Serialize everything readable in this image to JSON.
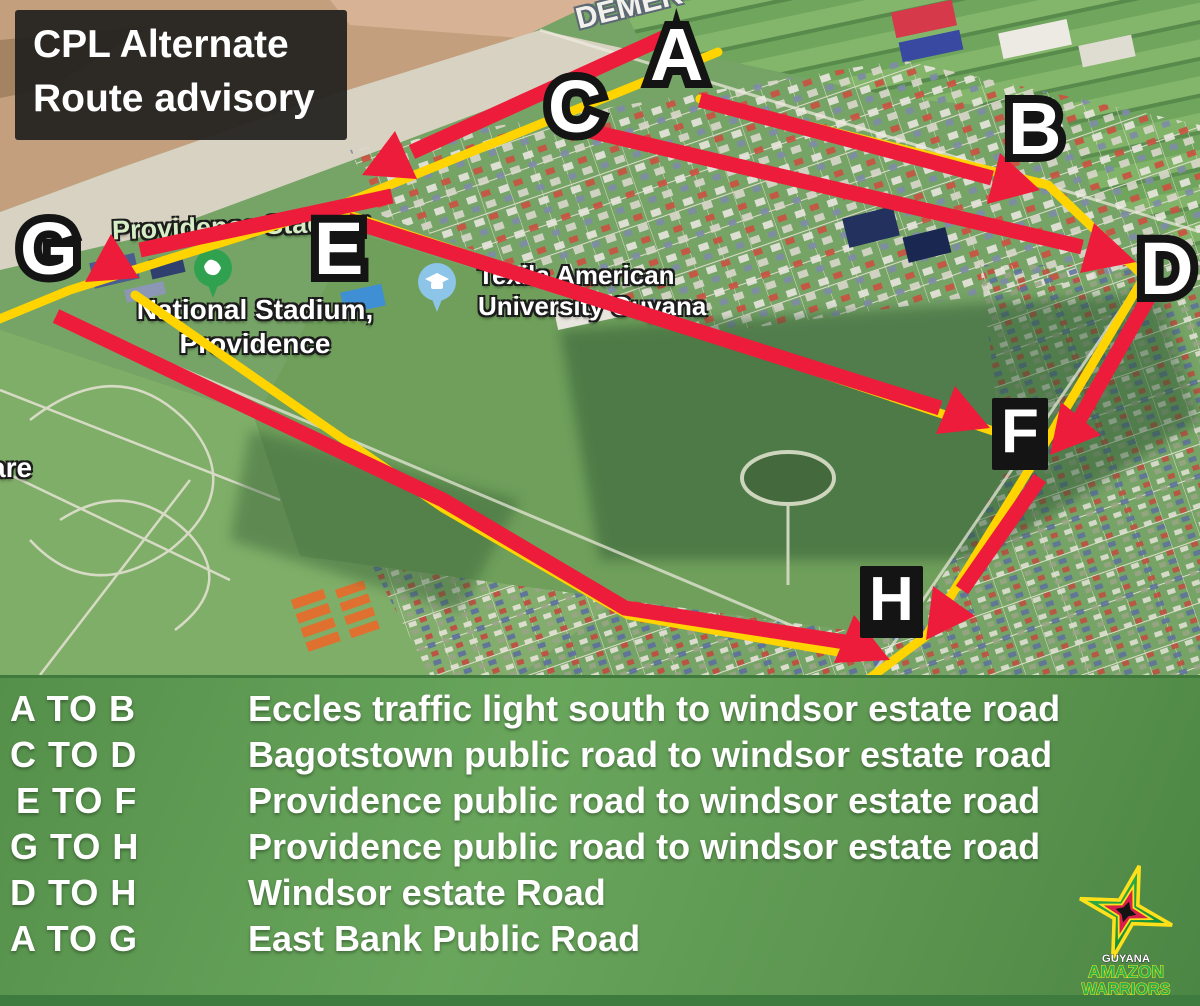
{
  "title_box": {
    "line1": "CPL Alternate",
    "line2": "Route advisory"
  },
  "map": {
    "markers": [
      {
        "letter": "A"
      },
      {
        "letter": "B"
      },
      {
        "letter": "C"
      },
      {
        "letter": "D"
      },
      {
        "letter": "E"
      },
      {
        "letter": "F"
      },
      {
        "letter": "G"
      },
      {
        "letter": "H"
      }
    ],
    "labels": {
      "river_road": "DEMER",
      "providence_stadium": "Providence Stadium",
      "national_stadium_line1": "National Stadium,",
      "national_stadium_line2": "Providence",
      "university_line1": "Texila American",
      "university_line2": "University Guyana",
      "left_edge_partial": "are"
    },
    "colors": {
      "route_red": "#ee1c3b",
      "route_yellow": "#ffd400"
    }
  },
  "legend": {
    "rows": [
      {
        "code": "A TO B",
        "desc": "Eccles traffic light south to windsor estate road"
      },
      {
        "code": "C TO D",
        "desc": "Bagotstown public road to windsor estate road"
      },
      {
        "code": "E TO F",
        "desc": "Providence public road to windsor estate road"
      },
      {
        "code": "G TO H",
        "desc": "Providence public road to windsor estate road"
      },
      {
        "code": "D TO H",
        "desc": "Windsor estate Road"
      },
      {
        "code": "A TO G",
        "desc": "East Bank Public Road"
      }
    ]
  },
  "logo": {
    "country": "GUYANA",
    "team_line1": "AMAZON",
    "team_line2": "WARRIORS"
  }
}
